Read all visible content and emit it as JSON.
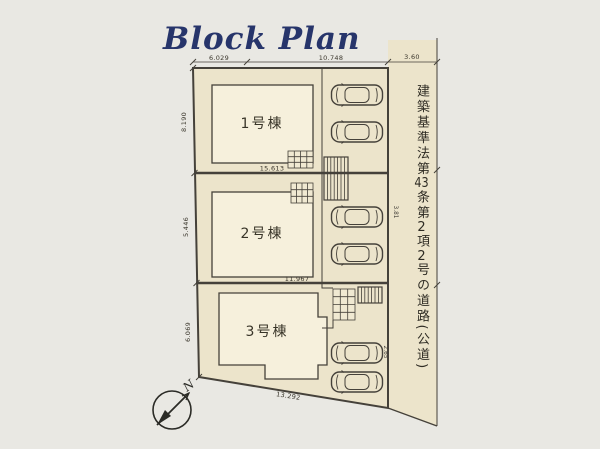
{
  "title": "Block Plan",
  "plots": {
    "building1": {
      "label": "1号棟",
      "width_dim": "15.613"
    },
    "building2": {
      "label": "2号棟",
      "width_dim": "11.967"
    },
    "building3": {
      "label": "3号棟",
      "width_dim": "13.292"
    }
  },
  "dims": {
    "top_left": "6.029",
    "top_mid": "10.748",
    "top_right": "3.60",
    "left_1": "8.190",
    "left_2": "5.446",
    "left_3": "6.069",
    "right_upper": "3.81",
    "right_lower": "2.65"
  },
  "road": {
    "s1": "建築基準法第",
    "n1": "43",
    "s2": "条第",
    "n2": "2",
    "s3": "項",
    "n3": "2",
    "s4": "号の道路",
    "s5": "(公道)"
  },
  "compass": {
    "north": "N"
  },
  "colors": {
    "title": "#27356b",
    "ground": "#ece4cb",
    "building": "#f6f0dc",
    "line": "#45413a",
    "paper": "#e9e8e3"
  }
}
